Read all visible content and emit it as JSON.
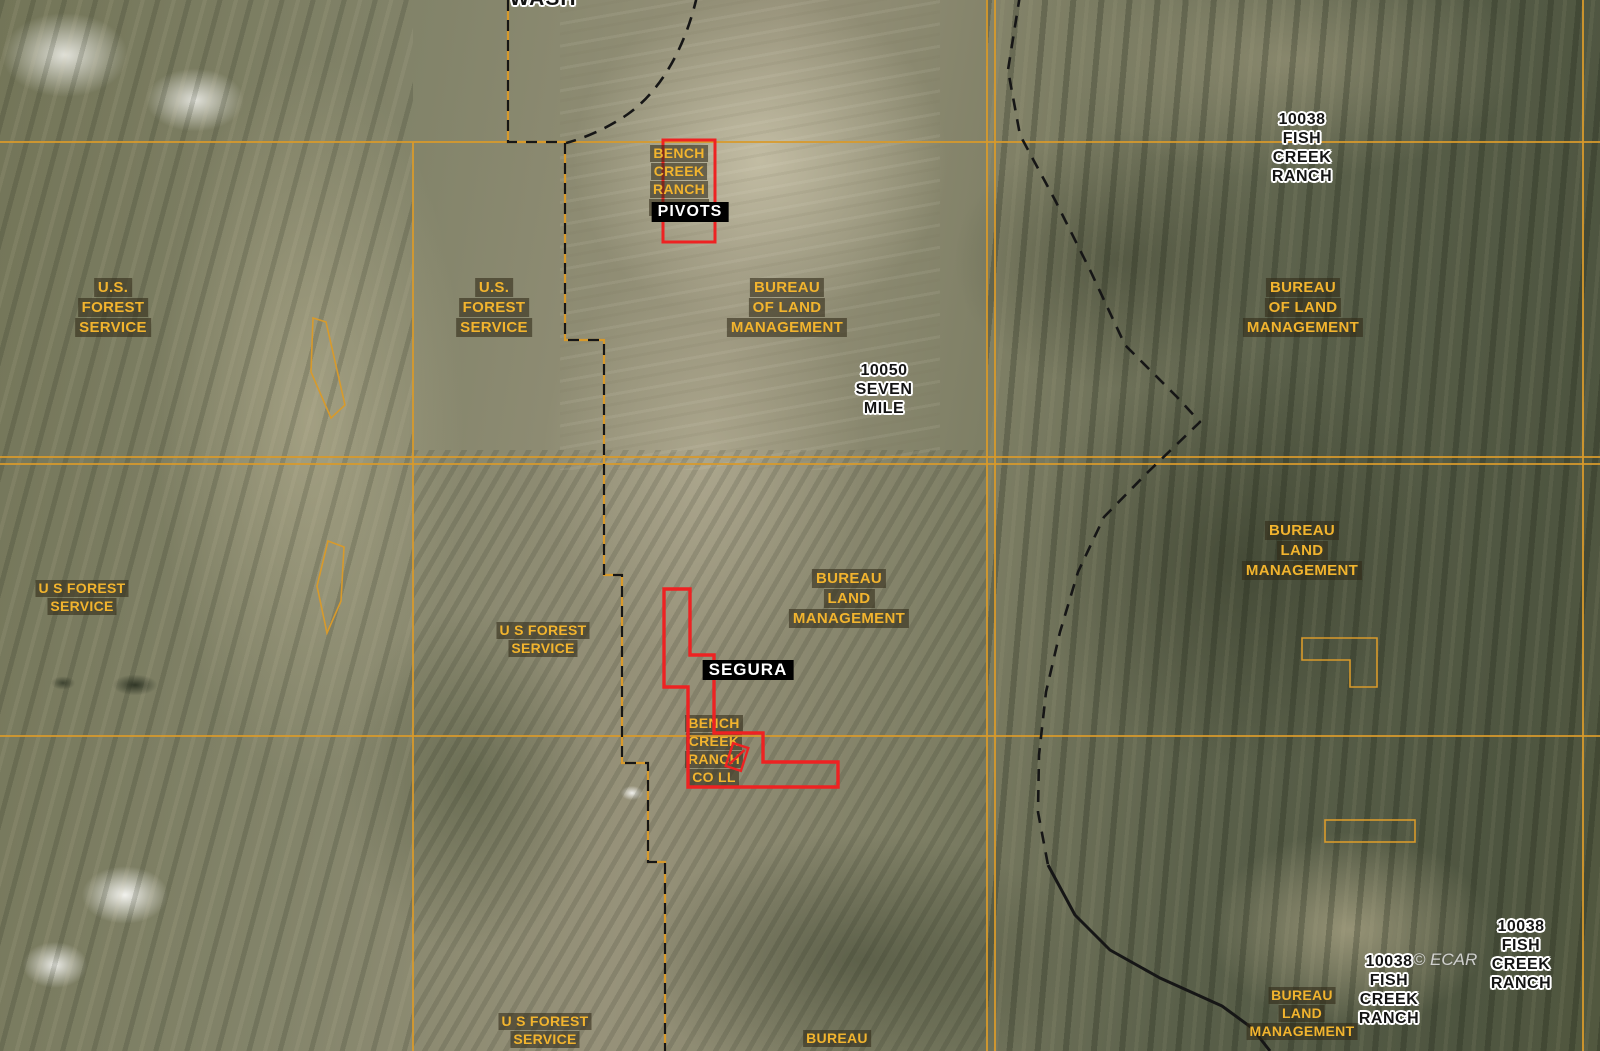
{
  "map": {
    "kind": "satellite-parcel-ownership-map",
    "highlighted_listing": "SEGURA / BENCH CREEK RANCH CO LLC parcels"
  },
  "colors": {
    "section_grid_orange": "#d89a2b",
    "boundary_dash_black": "#161616",
    "highlight_parcel_red": "#ee2222",
    "owner_label_yellow": "#f2b42e",
    "owner_label_box": "rgba(48,42,22,0.58)",
    "place_label_black": "#141414",
    "place_label_halo": "#ffffff",
    "watermark_gray": "#e4e4e4"
  },
  "labels": {
    "wash": {
      "lines": [
        "WASH"
      ]
    },
    "bench_creek_top": {
      "lines": [
        "BENCH",
        "CREEK",
        "RANCH",
        "CO LLC"
      ]
    },
    "pivots": {
      "lines": [
        "PIVOTS"
      ]
    },
    "usfs_left_top": {
      "lines": [
        "U.S.",
        "FOREST",
        "SERVICE"
      ]
    },
    "usfs_center_top": {
      "lines": [
        "U.S.",
        "FOREST",
        "SERVICE"
      ]
    },
    "blm_center_top": {
      "lines": [
        "BUREAU",
        "OF LAND",
        "MANAGEMENT"
      ]
    },
    "seven_mile": {
      "lines": [
        "10050",
        "SEVEN",
        "MILE"
      ]
    },
    "fish_creek_top": {
      "lines": [
        "10038",
        "FISH",
        "CREEK",
        "RANCH"
      ]
    },
    "blm_right_top": {
      "lines": [
        "BUREAU",
        "OF LAND",
        "MANAGEMENT"
      ]
    },
    "blm_right_mid": {
      "lines": [
        "BUREAU",
        "LAND",
        "MANAGEMENT"
      ]
    },
    "usfs_left_mid": {
      "lines": [
        "U S FOREST",
        "SERVICE"
      ]
    },
    "usfs_center_mid": {
      "lines": [
        "U S FOREST",
        "SERVICE"
      ]
    },
    "blm_center_mid": {
      "lines": [
        "BUREAU",
        "LAND",
        "MANAGEMENT"
      ]
    },
    "segura": {
      "lines": [
        "SEGURA"
      ]
    },
    "bench_creek_lower": {
      "lines": [
        "BENCH",
        "CREEK",
        "RANCH",
        "CO LL"
      ]
    },
    "usfs_bottom": {
      "lines": [
        "U S FOREST",
        "SERVICE"
      ]
    },
    "bureau_bottom": {
      "lines": [
        "BUREAU"
      ]
    },
    "blm_bottom_right": {
      "lines": [
        "BUREAU",
        "LAND",
        "MANAGEMENT"
      ]
    },
    "fish_creek_bottom_left": {
      "lines": [
        "10038",
        "FISH",
        "CREEK",
        "RANCH"
      ]
    },
    "ecar": {
      "lines": [
        "© ECAR"
      ]
    },
    "fish_creek_bottom_right": {
      "lines": [
        "10038",
        "FISH",
        "CREEK",
        "RANCH"
      ]
    }
  }
}
